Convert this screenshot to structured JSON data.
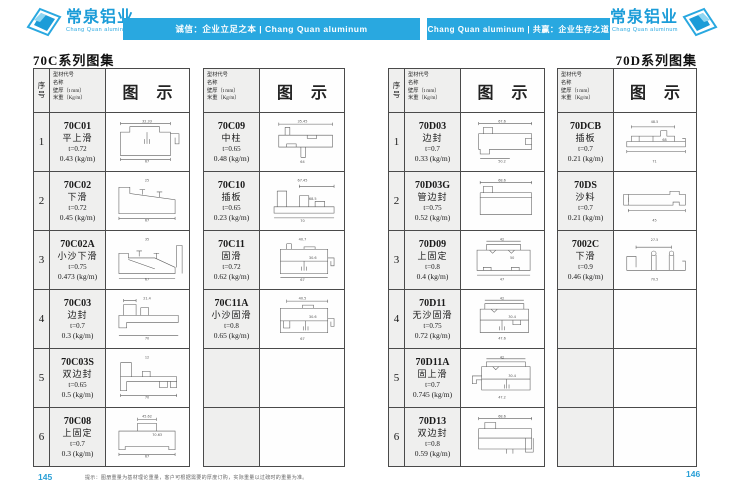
{
  "header": {
    "logo_left": {
      "title": "常泉铝业",
      "subtitle": "Chang Quan aluminum"
    },
    "banner_left": "诚信：企业立足之本 | Chang Quan aluminum",
    "banner_right": "Chang Quan aluminum | 共赢：企业生存之道",
    "logo_right": {
      "title": "常泉铝业",
      "subtitle": "Chang Quan aluminum"
    }
  },
  "page_left": {
    "title": "70C系列图集",
    "page_number": "145"
  },
  "page_right": {
    "title": "70D系列图集",
    "page_number": "146"
  },
  "table_header": {
    "seq": "序号",
    "spec_lines": [
      "型材代号",
      "名称",
      "壁厚（t mm）",
      "米重（Kg/m）"
    ],
    "diagram": "图 示"
  },
  "footer_note": "提示：图册重量为基材理论重量，客户可根据需要的厚度订购，实际重量以过磅时的重量为准。",
  "colors": {
    "brand_blue": "#29a8e0",
    "table_line": "#4a4a4a"
  },
  "tables": [
    {
      "id": "tableA",
      "has_seq": true,
      "rows": [
        {
          "seq": "1",
          "code": "70C01",
          "name": "平上滑",
          "thickness": "t=0.72",
          "weight": "0.43 (kg/m)",
          "diagram": "p70C01",
          "dims": [
            "32.33",
            "67"
          ]
        },
        {
          "seq": "2",
          "code": "70C02",
          "name": "下滑",
          "thickness": "t=0.72",
          "weight": "0.45 (kg/m)",
          "diagram": "p70C02",
          "dims": [
            "25",
            "67"
          ]
        },
        {
          "seq": "3",
          "code": "70C02A",
          "name": "小沙下滑",
          "thickness": "t=0.75",
          "weight": "0.473 (kg/m)",
          "diagram": "p70C02A",
          "dims": [
            "35",
            "67"
          ]
        },
        {
          "seq": "4",
          "code": "70C03",
          "name": "边封",
          "thickness": "t=0.7",
          "weight": "0.3 (kg/m)",
          "diagram": "p70C03",
          "dims": [
            "21.4",
            "70"
          ]
        },
        {
          "seq": "5",
          "code": "70C03S",
          "name": "双边封",
          "thickness": "t=0.65",
          "weight": "0.5 (kg/m)",
          "diagram": "p70C03S",
          "dims": [
            "12",
            "70"
          ]
        },
        {
          "seq": "6",
          "code": "70C08",
          "name": "上固定",
          "thickness": "t=0.7",
          "weight": "0.3 (kg/m)",
          "diagram": "p70C08",
          "dims": [
            "45.62",
            "67",
            "70.63"
          ]
        }
      ]
    },
    {
      "id": "tableB",
      "has_seq": false,
      "rows": [
        {
          "seq": "",
          "code": "70C09",
          "name": "中柱",
          "thickness": "t=0.65",
          "weight": "0.48 (kg/m)",
          "diagram": "p70C09",
          "dims": [
            "35.45",
            "64"
          ]
        },
        {
          "seq": "",
          "code": "70C10",
          "name": "插板",
          "thickness": "t=0.65",
          "weight": "0.23 (kg/m)",
          "diagram": "p70C10",
          "dims": [
            "67.45",
            "70",
            "68.5"
          ]
        },
        {
          "seq": "",
          "code": "70C11",
          "name": "固滑",
          "thickness": "t=0.72",
          "weight": "0.62 (kg/m)",
          "diagram": "p70C11",
          "dims": [
            "40.7",
            "67",
            "30.6"
          ]
        },
        {
          "seq": "",
          "code": "70C11A",
          "name": "小沙固滑",
          "thickness": "t=0.8",
          "weight": "0.65 (kg/m)",
          "diagram": "p70C11A",
          "dims": [
            "40.5",
            "67",
            "30.6"
          ]
        },
        {
          "seq": "",
          "code": "",
          "name": "",
          "thickness": "",
          "weight": "",
          "diagram": "",
          "dims": []
        },
        {
          "seq": "",
          "code": "",
          "name": "",
          "thickness": "",
          "weight": "",
          "diagram": "",
          "dims": []
        }
      ]
    },
    {
      "id": "tableC",
      "has_seq": true,
      "rows": [
        {
          "seq": "1",
          "code": "70D03",
          "name": "边封",
          "thickness": "t=0.7",
          "weight": "0.33 (kg/m)",
          "diagram": "p70D03",
          "dims": [
            "67.6",
            "50.2"
          ]
        },
        {
          "seq": "2",
          "code": "70D03G",
          "name": "管边封",
          "thickness": "t=0.75",
          "weight": "0.52 (kg/m)",
          "diagram": "p70D03G",
          "dims": [
            "68.6"
          ]
        },
        {
          "seq": "3",
          "code": "70D09",
          "name": "上固定",
          "thickness": "t=0.8",
          "weight": "0.4 (kg/m)",
          "diagram": "p70D09",
          "dims": [
            "42",
            "47",
            "50"
          ]
        },
        {
          "seq": "4",
          "code": "70D11",
          "name": "无沙固滑",
          "thickness": "t=0.75",
          "weight": "0.72 (kg/m)",
          "diagram": "p70D11",
          "dims": [
            "42",
            "47.6",
            "30.4"
          ]
        },
        {
          "seq": "5",
          "code": "70D11A",
          "name": "固上滑",
          "thickness": "t=0.7",
          "weight": "0.745 (kg/m)",
          "diagram": "p70D11A",
          "dims": [
            "42",
            "47.2",
            "30.4"
          ]
        },
        {
          "seq": "6",
          "code": "70D13",
          "name": "双边封",
          "thickness": "t=0.8",
          "weight": "0.59 (kg/m)",
          "diagram": "p70D13",
          "dims": [
            "68.6"
          ]
        }
      ]
    },
    {
      "id": "tableD",
      "has_seq": false,
      "rows": [
        {
          "seq": "",
          "code": "70DCB",
          "name": "插板",
          "thickness": "t=0.7",
          "weight": "0.21 (kg/m)",
          "diagram": "p70DCB",
          "dims": [
            "48.5",
            "71",
            "68"
          ]
        },
        {
          "seq": "",
          "code": "70DS",
          "name": "沙料",
          "thickness": "t=0.7",
          "weight": "0.21 (kg/m)",
          "diagram": "p70DS",
          "dims": [
            "",
            "45"
          ]
        },
        {
          "seq": "",
          "code": "7002C",
          "name": "下滑",
          "thickness": "t=0.9",
          "weight": "0.46 (kg/m)",
          "diagram": "p7002C",
          "dims": [
            "27.5",
            "70.5"
          ]
        },
        {
          "seq": "",
          "code": "",
          "name": "",
          "thickness": "",
          "weight": "",
          "diagram": "",
          "dims": []
        },
        {
          "seq": "",
          "code": "",
          "name": "",
          "thickness": "",
          "weight": "",
          "diagram": "",
          "dims": []
        },
        {
          "seq": "",
          "code": "",
          "name": "",
          "thickness": "",
          "weight": "",
          "diagram": "",
          "dims": []
        }
      ]
    }
  ]
}
